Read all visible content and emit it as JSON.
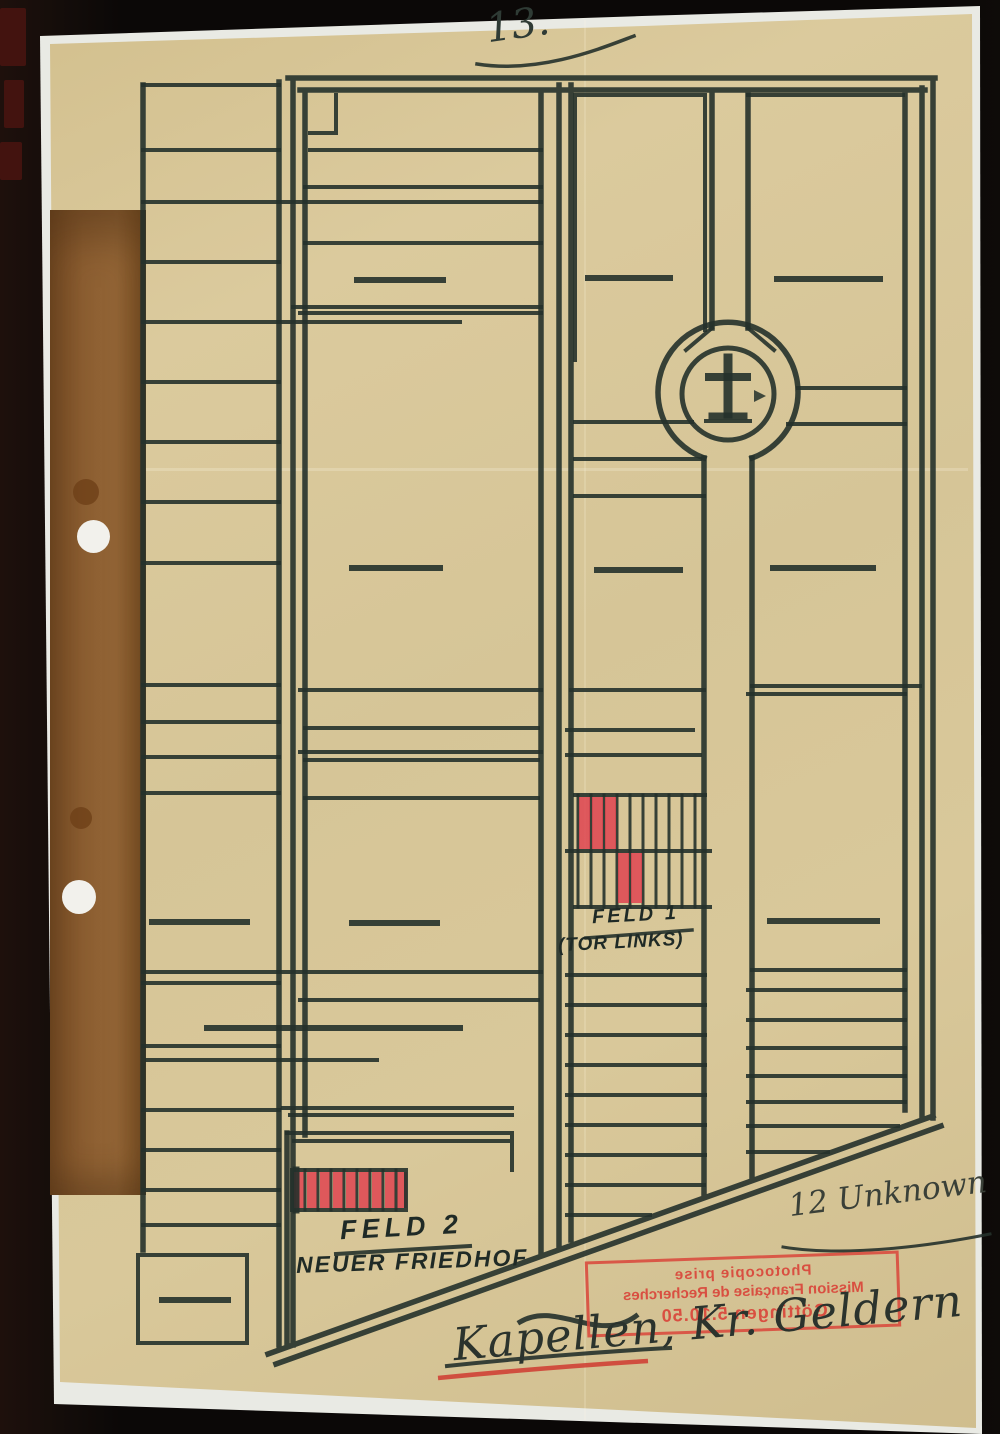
{
  "annotations": {
    "page_number": "13.",
    "grave_count_note": "12 Unknown",
    "location_note": "Kapellen, Kr. Geldern"
  },
  "plan": {
    "field1_label": "FELD 1",
    "field1_sublabel": "(TOR LINKS)",
    "field2_label": "FELD 2",
    "field2_sublabel": "NEUER FRIEDHOF",
    "chapel_symbol": "cross"
  },
  "stamp": {
    "line1": "Photocopie prise",
    "line2": "Mission Française de Recherches",
    "line3": "Göttingen 5.10.50",
    "mirrored": true
  },
  "colors": {
    "paper": "#d6c597",
    "ink": "#25312b",
    "red_marker": "#e0394a",
    "stamp_red": "#d9453a",
    "backing_strip": "#8c5e31",
    "background": "#0c0908"
  }
}
